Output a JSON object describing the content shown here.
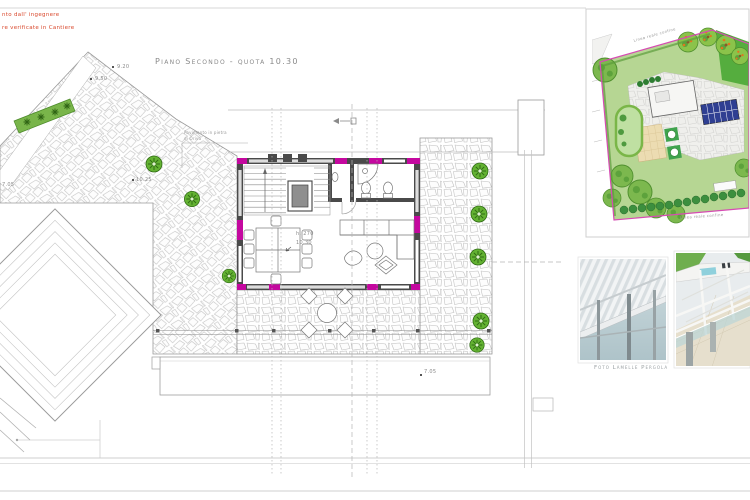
{
  "sheet": {
    "notes": [
      "nto dall' ingegnere",
      "re verificate in Cantiere"
    ],
    "title": "Piano Secondo - quota 10.30"
  },
  "plan": {
    "spot_heights": {
      "nw_upper": "9.20",
      "nw_lower": "9.50",
      "left": "7.05",
      "terrace": "10.25",
      "lower_roof": "7.05"
    },
    "height_note": {
      "line1": "h. 270",
      "line2": "10.30"
    },
    "paving_note": {
      "line1": "Pavimento in pietra",
      "line2": "di Oriva"
    }
  },
  "site_plan": {
    "boundary_label": "Linea reale confine"
  },
  "photos": {
    "pergola_caption": "Foto Lamelle Pergola"
  },
  "colors": {
    "annotation_red": "#d9472b",
    "text_gray": "#8a8a8a",
    "line_gray": "#9a9a9a",
    "wall_dark": "#4a4a4a",
    "magenta": "#c4089f",
    "shrub_green": "#63b232",
    "lawn_green": "#b6d693",
    "bright_lawn": "#55ad3e",
    "boundary_pink": "#d64bb3",
    "solar_blue": "#2f3f92",
    "patio_beige": "#ecdcb2",
    "photo_sky": "#c3d6da"
  }
}
